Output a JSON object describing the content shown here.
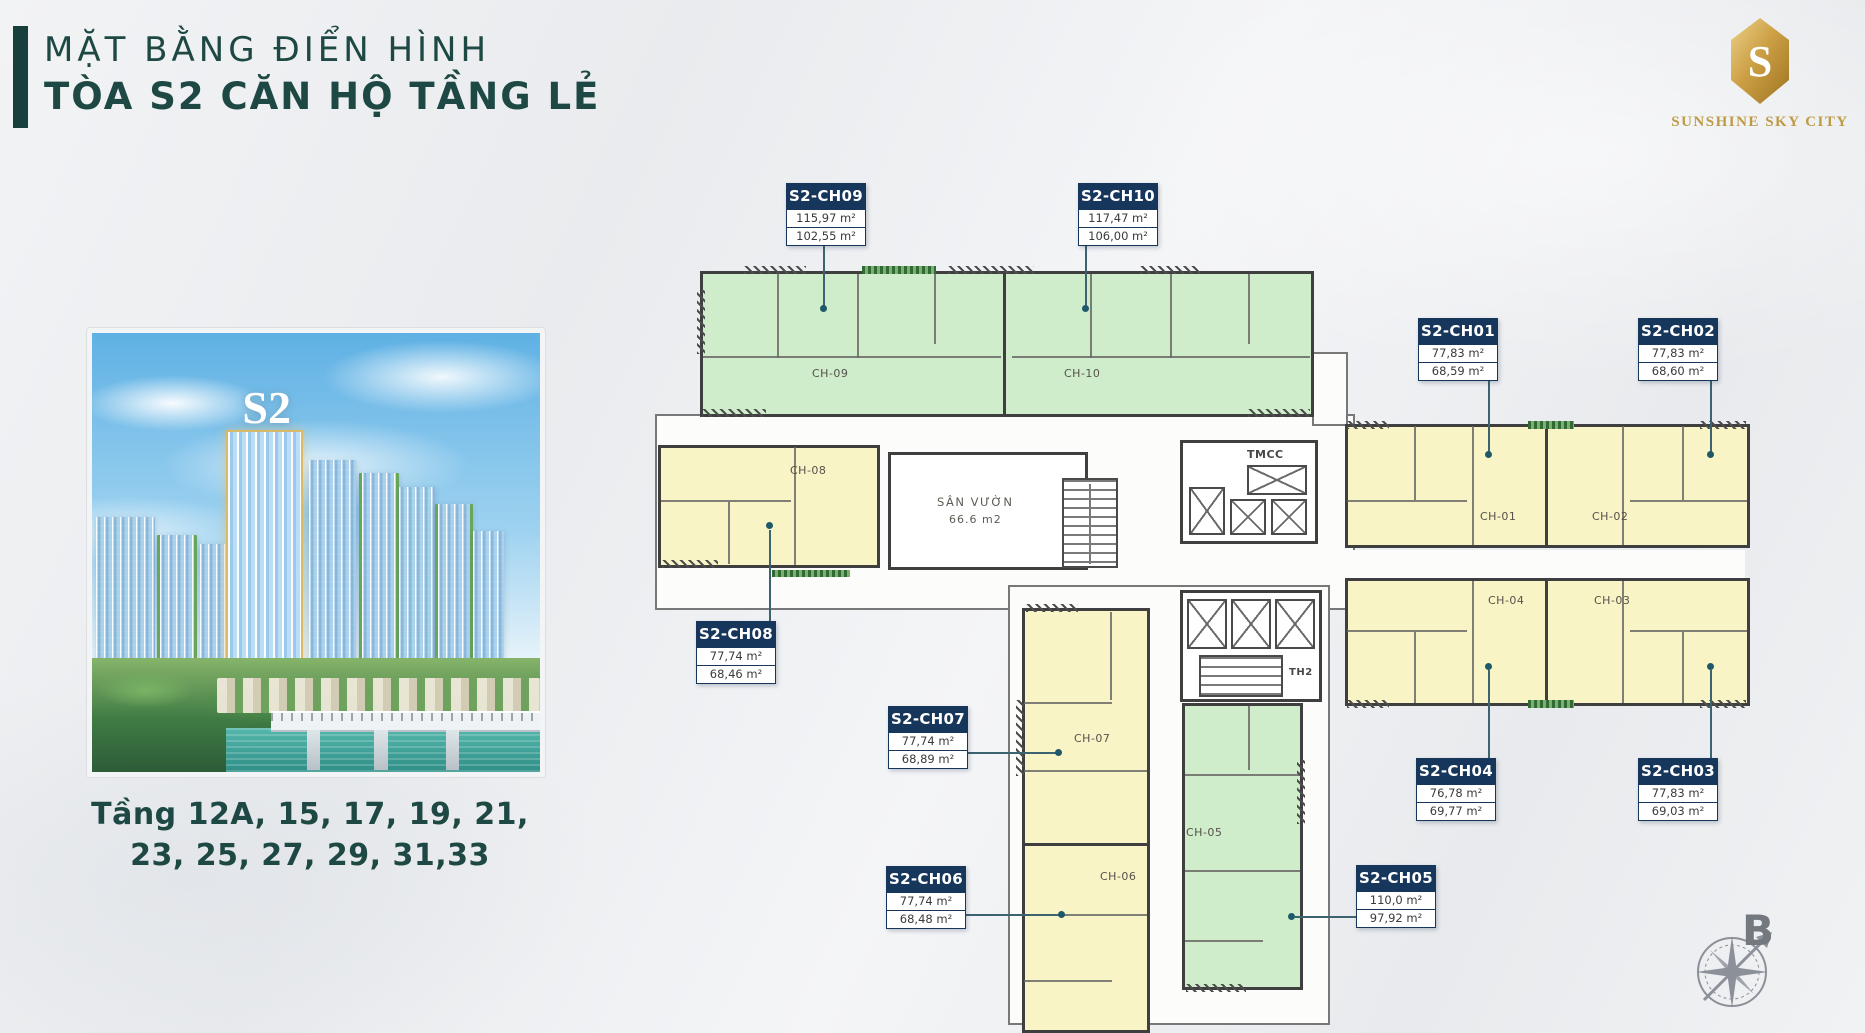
{
  "header": {
    "title_line1": "MẶT BẰNG ĐIỂN HÌNH",
    "title_line2": "TÒA S2 CĂN HỘ TẦNG LẺ"
  },
  "brand": {
    "name": "SUNSHINE SKY CITY",
    "monogram": "S"
  },
  "left_panel": {
    "tower_badge": "S2",
    "floors_line1": "Tầng 12A, 15, 17, 19, 21,",
    "floors_line2": "23, 25, 27, 29, 31,33"
  },
  "plan": {
    "garden_label": "SÂN VƯỜN",
    "garden_area": "66.6 m2",
    "core1_label": "TMCC",
    "core2_label": "TH2",
    "compass_label": "B",
    "units": [
      {
        "id": "S2-CH09",
        "area1": "115,97 m²",
        "area2": "102,55 m²",
        "room": "CH-09",
        "fill": "green"
      },
      {
        "id": "S2-CH10",
        "area1": "117,47 m²",
        "area2": "106,00 m²",
        "room": "CH-10",
        "fill": "green"
      },
      {
        "id": "S2-CH01",
        "area1": "77,83 m²",
        "area2": "68,59 m²",
        "room": "CH-01",
        "fill": "yellow"
      },
      {
        "id": "S2-CH02",
        "area1": "77,83 m²",
        "area2": "68,60 m²",
        "room": "CH-02",
        "fill": "yellow"
      },
      {
        "id": "S2-CH03",
        "area1": "77,83 m²",
        "area2": "69,03 m²",
        "room": "CH-03",
        "fill": "yellow"
      },
      {
        "id": "S2-CH04",
        "area1": "76,78 m²",
        "area2": "69,77 m²",
        "room": "CH-04",
        "fill": "yellow"
      },
      {
        "id": "S2-CH05",
        "area1": "110,0 m²",
        "area2": "97,92 m²",
        "room": "CH-05",
        "fill": "green"
      },
      {
        "id": "S2-CH06",
        "area1": "77,74 m²",
        "area2": "68,48 m²",
        "room": "CH-06",
        "fill": "yellow"
      },
      {
        "id": "S2-CH07",
        "area1": "77,74 m²",
        "area2": "68,89 m²",
        "room": "CH-07",
        "fill": "yellow"
      },
      {
        "id": "S2-CH08",
        "area1": "77,74 m²",
        "area2": "68,46 m²",
        "room": "CH-08",
        "fill": "yellow"
      }
    ],
    "colors": {
      "accent_teal": "#1d4843",
      "label_navy": "#17365c",
      "unit_green": "#cfeccb",
      "unit_yellow": "#f8f4c6",
      "brand_gold": "#bf9a45",
      "wall": "#3f3f3f"
    }
  }
}
